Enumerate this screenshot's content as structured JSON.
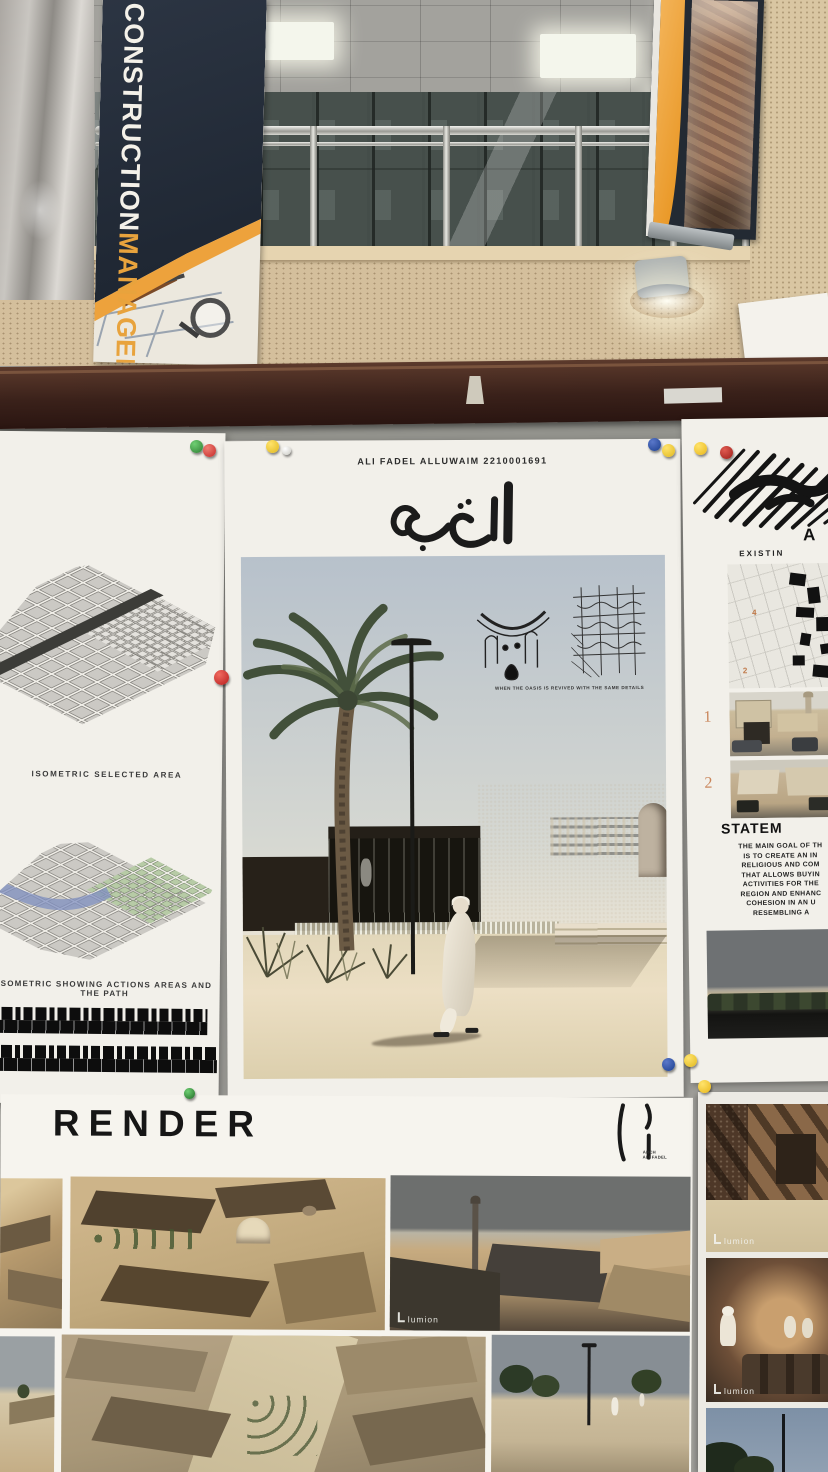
{
  "scene": {
    "description": "Architecture jury posters pinned on a display board in a university hallway"
  },
  "hallway": {
    "left_banner": {
      "line1": "CONSTRUCTION",
      "line2": "MANAGEMENT"
    }
  },
  "left_poster": {
    "caption_selected": "ISOMETRIC SELECTED AREA",
    "caption_actions": "ISOMETRIC SHOWING ACTIONS AREAS AND THE PATH"
  },
  "center_poster": {
    "author_line": "ALI FADEL ALLUWAIM  2210001691",
    "arabic_title": "السيفة",
    "sketch_caption": "WHEN THE OASIS IS REVIVED WITH THE SAME  DETAILS"
  },
  "right_poster": {
    "heading_fragment": "A",
    "subheading_fragment": "EXISTIN",
    "map_numbers": [
      "4",
      "2",
      "3"
    ],
    "photo_numbers": [
      "1",
      "2"
    ],
    "statement_title_fragment": "STATEM",
    "statement_lines": [
      "THE MAIN GOAL OF TH",
      "IS TO CREATE AN IN",
      "RELIGIOUS AND COM",
      "THAT ALLOWS BUYIN",
      "ACTIVITIES FOR THE",
      "REGION AND ENHANC",
      "COHESION IN AN U",
      "RESEMBLING A"
    ]
  },
  "bottom_section": {
    "heading": "RENDER",
    "logo_line1": "ARCH",
    "logo_line2": "ALI FADEL",
    "watermark": "lumion"
  },
  "colors": {
    "banner_navy": "#232a33",
    "banner_orange": "#eda23c",
    "board_gray": "#a3a29d",
    "wood_rail": "#3a211a",
    "poster_white": "#f2f0ea",
    "building_dark": "#2c2620",
    "sand": "#e2d7ba",
    "sky_render": "#b7c1cb",
    "pin_green": "#2e7d32",
    "pin_red": "#c62828",
    "pin_yellow": "#f3cf2f",
    "pin_blue": "#1c3f8f"
  }
}
